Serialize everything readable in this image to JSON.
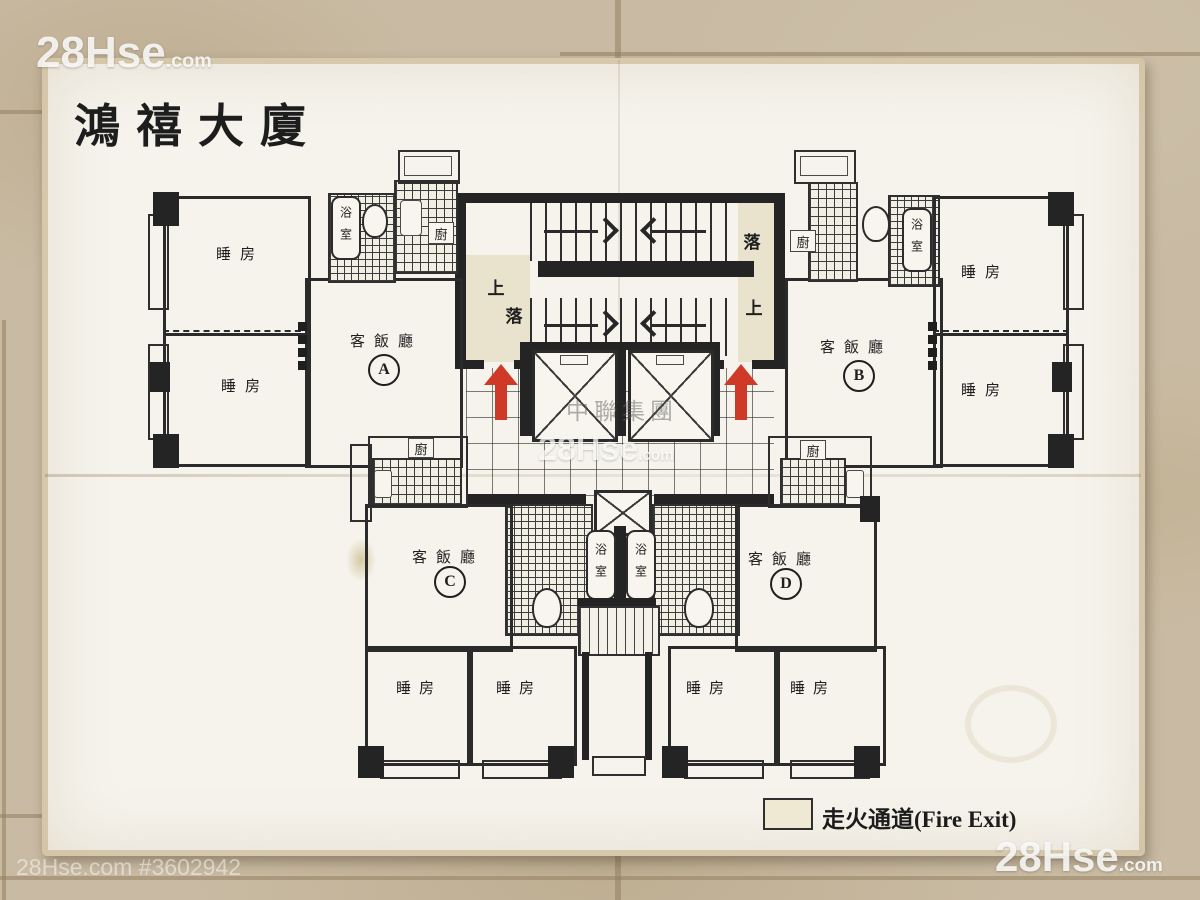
{
  "photo": {
    "watermark_brand": "28Hse",
    "watermark_brand_suffix": ".com",
    "watermark_listing": "28Hse.com #3602942",
    "watermark_agency": "中聯集團"
  },
  "plan": {
    "building_title": "鴻禧大廈",
    "legend_fire_exit": "走火通道(Fire Exit)",
    "stair_up": "上",
    "stair_down": "落",
    "room_living": "客飯廳",
    "room_bedroom": "睡房",
    "room_bath": "浴室",
    "room_kitchen": "廚",
    "unit_a": "A",
    "unit_b": "B",
    "unit_c": "C",
    "unit_d": "D",
    "colors": {
      "fire_exit_fill": "#e9e2cd",
      "arrow_red": "#cf3a28",
      "ink": "#2b2b2b",
      "paper": "#f5f3ec",
      "floor_tile": "#c9bba3"
    }
  }
}
